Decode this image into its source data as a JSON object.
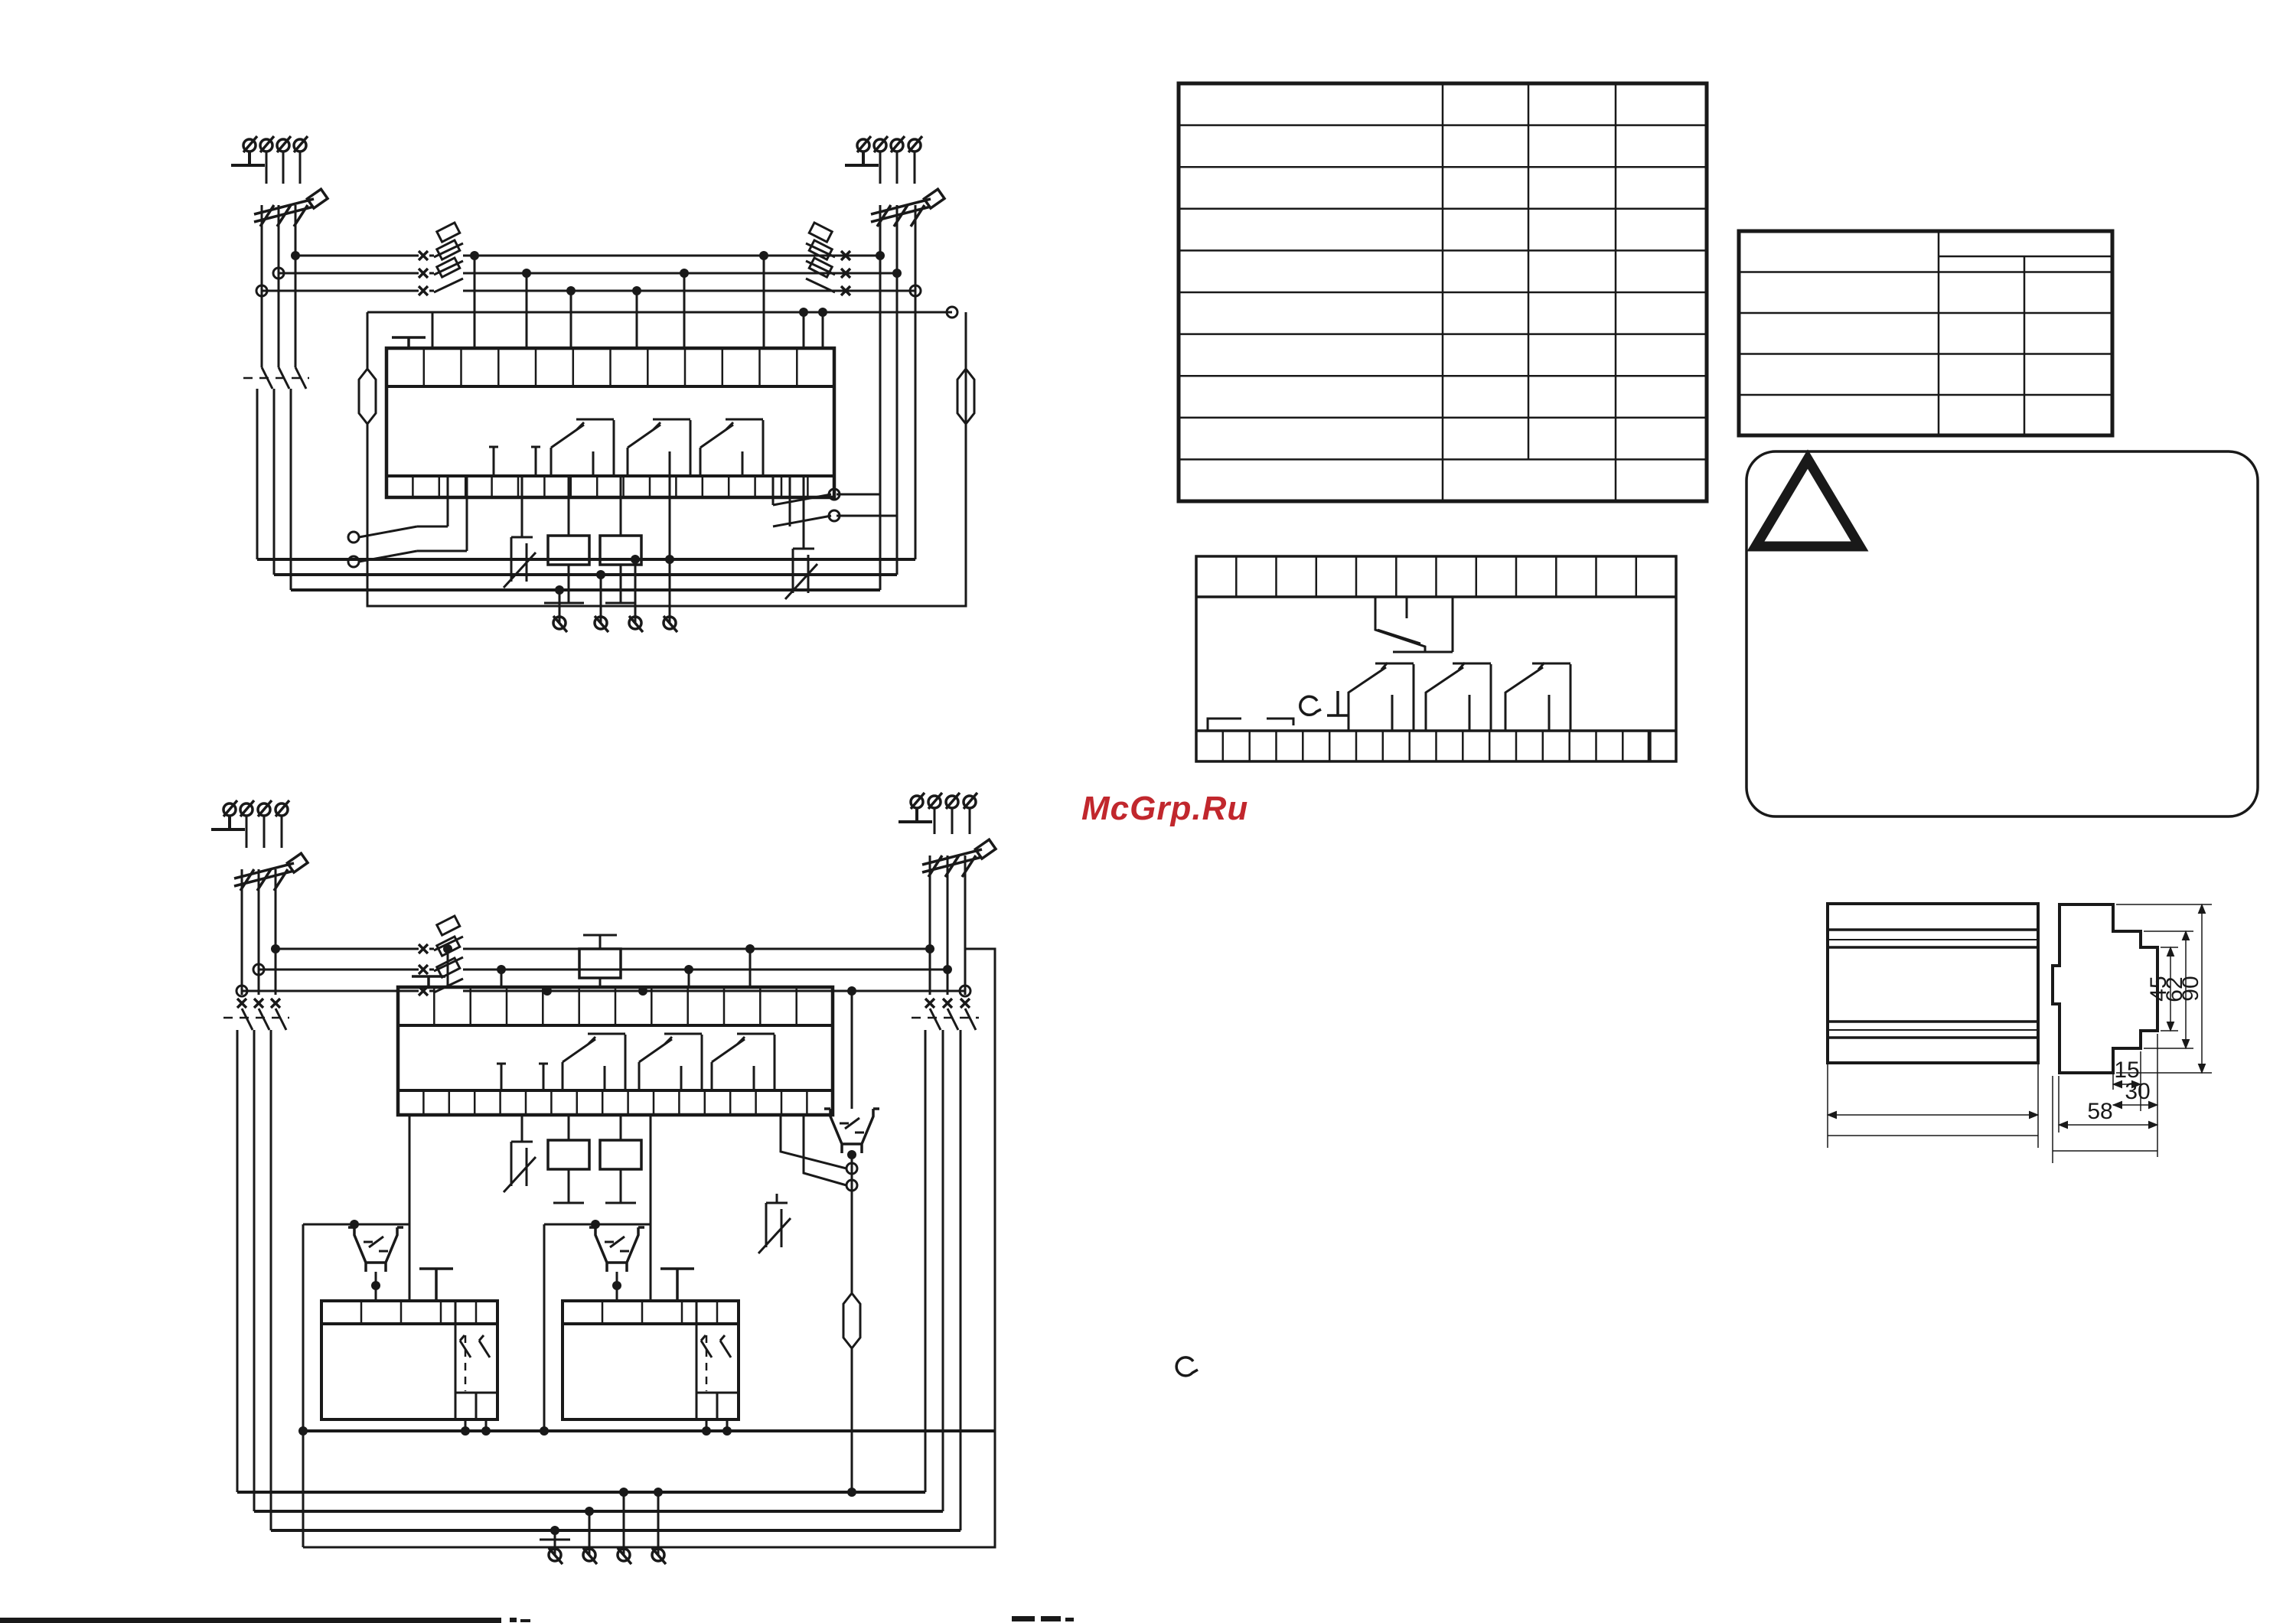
{
  "page": {
    "background": "#ffffff",
    "line_color": "#191919"
  },
  "watermark": {
    "text": "McGrp.Ru",
    "color": "#c1272d"
  },
  "spec_table": {
    "rows": 10,
    "columns": 4,
    "cells_empty": true,
    "last_row_middle_columns_merged": true
  },
  "contact_table": {
    "data_rows": 4,
    "columns": 3,
    "header_right_split_into_subcolumns": true,
    "cells_empty": true
  },
  "warning_panel": {
    "icon": "warning-triangle",
    "text": ""
  },
  "terminal_module": {
    "top_cells": 12,
    "bottom_cells": 18,
    "relay_contacts": 3,
    "icon": "relay-module"
  },
  "schematic_top": {
    "feeder_terminals_left": 4,
    "feeder_terminals_right": 4,
    "phase_rows": 3,
    "block_top_cells": 12,
    "block_bottom_cells": 17,
    "bottom_terminals": 4
  },
  "schematic_bottom": {
    "feeder_terminals_left": 4,
    "feeder_terminals_right": 4,
    "phase_rows": 3,
    "block_top_cells": 12,
    "block_bottom_cells": 17,
    "submodules": 2,
    "bottom_terminals": 4
  },
  "dimension_drawing": {
    "vertical_labels": [
      "45",
      "62",
      "90"
    ],
    "horizontal_labels": [
      "15",
      "30",
      "58"
    ]
  }
}
